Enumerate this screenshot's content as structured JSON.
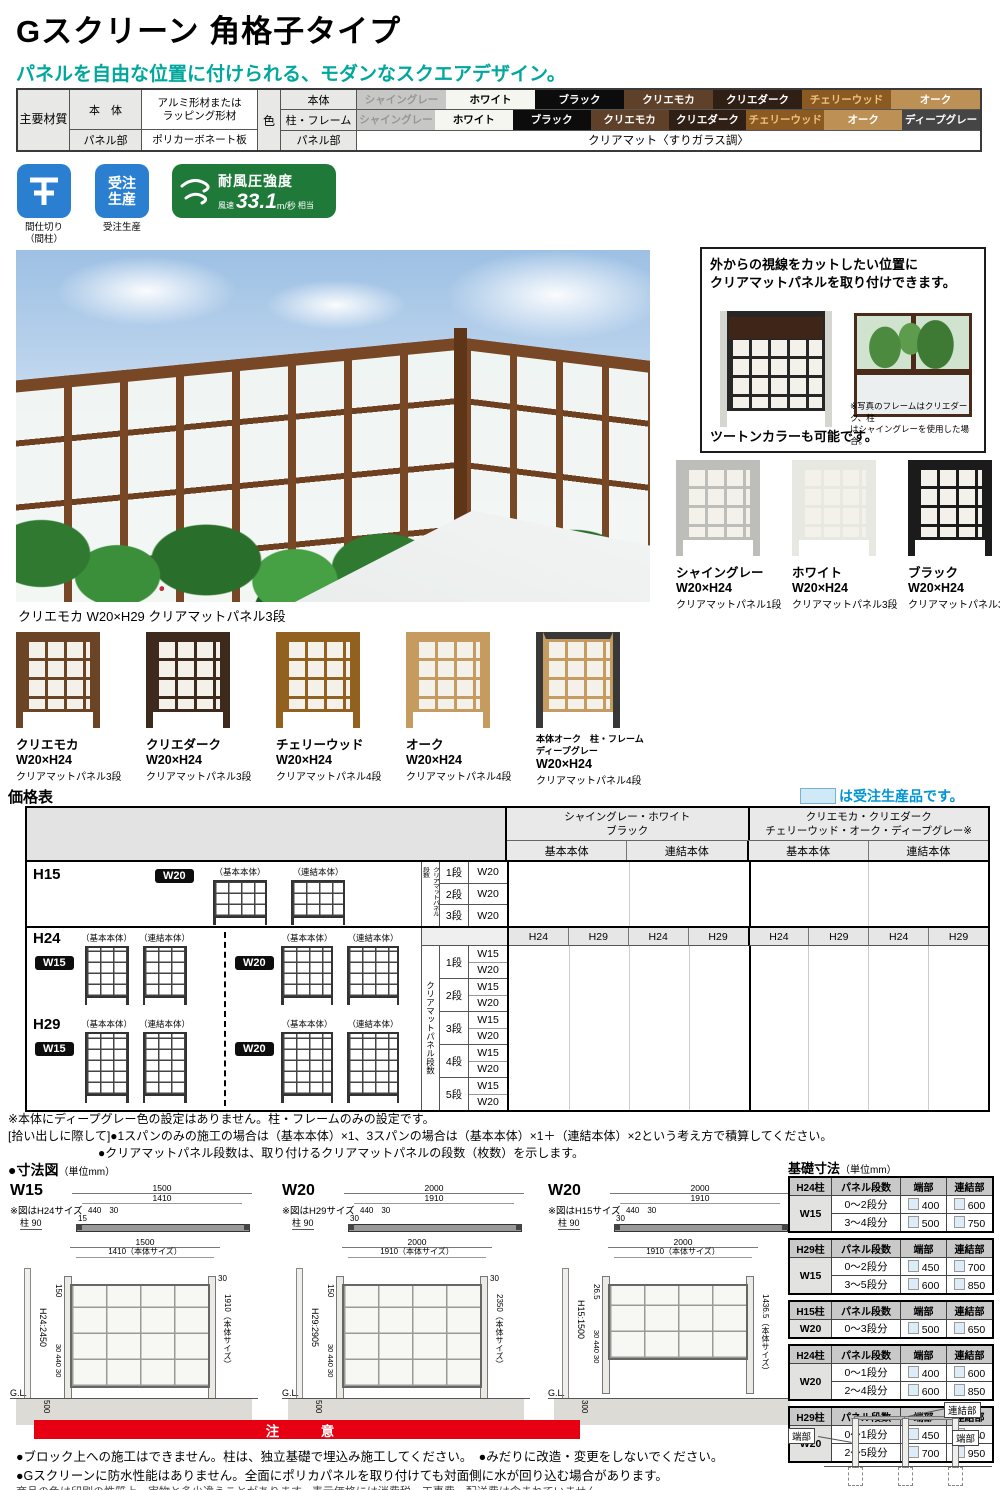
{
  "header": {
    "title": "Gスクリーン 角格子タイプ",
    "subtitle": "パネルを自由な位置に付けられる、モダンなスクエアデザイン。"
  },
  "colors": {
    "accent_teal": "#00a79c",
    "badge_blue": "#2b7fd0",
    "badge_green": "#1f7a3a",
    "notice_red": "#e60012",
    "order_note_blue": "#0096d6",
    "order_box_fill": "#cfe9f7"
  },
  "materials": {
    "main_label": "主要材質",
    "body_label": "本　体",
    "body_material_line1": "アルミ形材または",
    "body_material_line2": "ラッピング形材",
    "panel_label": "パネル部",
    "panel_material": "ポリカーボネート板",
    "color_label": "色",
    "color_rows": [
      {
        "label": "本体",
        "swatches": [
          {
            "name": "シャイングレー",
            "bg": "#c7c7c5",
            "fg": "#969694"
          },
          {
            "name": "ホワイト",
            "bg": "#f6f6f1",
            "fg": "#000000"
          },
          {
            "name": "ブラック",
            "bg": "#0c0c0c",
            "fg": "#ffffff"
          },
          {
            "name": "クリエモカ",
            "bg": "#5f4028",
            "fg": "#ffffff"
          },
          {
            "name": "クリエダーク",
            "bg": "#301f15",
            "fg": "#ffffff"
          },
          {
            "name": "チェリーウッド",
            "bg": "#8a5a22",
            "fg": "#f0c27d"
          },
          {
            "name": "オーク",
            "bg": "#bd9055",
            "fg": "#ffffff"
          }
        ]
      },
      {
        "label": "柱・フレーム",
        "swatches": [
          {
            "name": "シャイングレー",
            "bg": "#c7c7c5",
            "fg": "#969694"
          },
          {
            "name": "ホワイト",
            "bg": "#f6f6f1",
            "fg": "#000000"
          },
          {
            "name": "ブラック",
            "bg": "#0c0c0c",
            "fg": "#ffffff"
          },
          {
            "name": "クリエモカ",
            "bg": "#5f4028",
            "fg": "#ffffff"
          },
          {
            "name": "クリエダーク",
            "bg": "#301f15",
            "fg": "#ffffff"
          },
          {
            "name": "チェリーウッド",
            "bg": "#8a5a22",
            "fg": "#f0c27d"
          },
          {
            "name": "オーク",
            "bg": "#bd9055",
            "fg": "#ffffff"
          },
          {
            "name": "ディープグレー",
            "bg": "#454545",
            "fg": "#ffffff"
          }
        ]
      },
      {
        "label": "パネル部",
        "value": "クリアマット〈すりガラス調〉"
      }
    ]
  },
  "badges": {
    "partition_label1": "間仕切り",
    "partition_label2": "（間柱）",
    "order_icon_line1": "受注",
    "order_icon_line2": "生産",
    "order_label": "受注生産",
    "wind_title": "耐風圧強度",
    "wind_prefix": "風速",
    "wind_value": "33.1",
    "wind_unit": "m/秒",
    "wind_suffix": "相当"
  },
  "info_panel": {
    "title_line1": "外からの視線をカットしたい位置に",
    "title_line2": "クリアマットパネルを取り付けできます。",
    "caption_left": "ツートンカラーも可能です。",
    "caption_right_line1": "※写真のフレームはクリエダーク、柱",
    "caption_right_line2": "はシャイングレーを使用した場合。"
  },
  "variations": {
    "hero_caption": "クリエモカ W20×H29 クリアマットパネル3段",
    "right": [
      {
        "name": "シャイングレー",
        "size": "W20×H24",
        "panel": "クリアマットパネル1段",
        "frame": "#bdbdb9",
        "post": "#bdbdb9"
      },
      {
        "name": "ホワイト",
        "size": "W20×H24",
        "panel": "クリアマットパネル3段",
        "frame": "#e8e8e2",
        "post": "#e8e8e2"
      },
      {
        "name": "ブラック",
        "size": "W20×H24",
        "panel": "クリアマットパネル3段",
        "frame": "#1b1b1b",
        "post": "#1b1b1b"
      }
    ],
    "bottom": [
      {
        "name": "クリエモカ",
        "size": "W20×H24",
        "panel": "クリアマットパネル3段",
        "frame": "#6b4426",
        "post": "#6b4426"
      },
      {
        "name": "クリエダーク",
        "size": "W20×H24",
        "panel": "クリアマットパネル3段",
        "frame": "#3e2a1c",
        "post": "#3e2a1c"
      },
      {
        "name": "チェリーウッド",
        "size": "W20×H24",
        "panel": "クリアマットパネル4段",
        "frame": "#92601f",
        "post": "#92601f"
      },
      {
        "name": "オーク",
        "size": "W20×H24",
        "panel": "クリアマットパネル4段",
        "frame": "#c59b5f",
        "post": "#c59b5f"
      },
      {
        "name": "本体オーク　柱・フレームディープグレー",
        "size": "W20×H24",
        "panel": "クリアマットパネル4段",
        "frame": "#c59b5f",
        "post": "#383838",
        "topbar": "#383838",
        "small": true
      }
    ]
  },
  "price": {
    "heading": "価格表",
    "order_note": "は受注生産品です。",
    "groups": [
      {
        "line1": "シャイングレー・ホワイト",
        "line2": "ブラック"
      },
      {
        "line1": "クリエモカ・クリエダーク",
        "line2": "チェリーウッド・オーク・ディープグレー※"
      }
    ],
    "sub_cols": [
      "基本本体",
      "連結本体",
      "基本本体",
      "連結本体"
    ],
    "basic_label": "（基本本体）",
    "joint_label": "（連結本体）",
    "vertical_label": "クリアマットパネル段数",
    "h15_label": "H15",
    "h24_label": "H24",
    "h29_label": "H29",
    "w15_badge": "W15",
    "w20_badge": "W20",
    "h15_stages": [
      [
        "1段",
        "W20"
      ],
      [
        "2段",
        "W20"
      ],
      [
        "3段",
        "W20"
      ]
    ],
    "h_subheader": [
      "H24",
      "H29",
      "H24",
      "H29",
      "H24",
      "H29",
      "H24",
      "H29"
    ],
    "stages": [
      [
        "1段",
        "W15",
        "W20"
      ],
      [
        "2段",
        "W15",
        "W20"
      ],
      [
        "3段",
        "W15",
        "W20"
      ],
      [
        "4段",
        "W15",
        "W20"
      ],
      [
        "5段",
        "W15",
        "W20"
      ]
    ],
    "notes": [
      "※本体にディープグレー色の設定はありません。柱・フレームのみの設定です。",
      "[拾い出しに際して]●1スパンのみの施工の場合は（基本本体）×1、3スパンの場合は（基本本体）×1＋（連結本体）×2という考え方で積算してください。",
      "●クリアマットパネル段数は、取り付けるクリアマットパネルの段数（枚数）を示します。"
    ]
  },
  "dimensions": {
    "heading": "●寸法図",
    "unit": "（単位mm）",
    "diagrams": [
      {
        "name": "W15",
        "note": "※図はH24サイズ",
        "tw1": "1500",
        "tw2": "1410",
        "tsub": "440　30",
        "textra": "15",
        "tpost": "柱 90",
        "fw1": "1500",
        "fw2": "1410（本体サイズ）",
        "foff": "150",
        "fh": "H24:2450",
        "fbot": "30 440 30",
        "ftr": "30",
        "fbody": "1910（本体サイズ）",
        "fgl": "G.L.",
        "fdepth": "500"
      },
      {
        "name": "W20",
        "note": "※図はH29サイズ",
        "tw1": "2000",
        "tw2": "1910",
        "tsub": "440　30",
        "textra": "30",
        "tpost": "柱 90",
        "fw1": "2000",
        "fw2": "1910（本体サイズ）",
        "foff": "150",
        "fh": "H29:2905",
        "fbot": "30 440 30",
        "ftr": "30",
        "fbody": "2350（本体サイズ）",
        "fgl": "G.L.",
        "fdepth": "500"
      },
      {
        "name": "W20",
        "note": "※図はH15サイズ",
        "tw1": "2000",
        "tw2": "1910",
        "tsub": "440　30",
        "textra": "30",
        "tpost": "柱 90",
        "fw1": "2000",
        "fw2": "1910（本体サイズ）",
        "foff": "26.5",
        "fh": "H15:1500",
        "fbot": "30 440 30",
        "ftr": "",
        "fbody": "1436.5（本体サイズ）",
        "fgl": "G.L.",
        "fdepth": "300"
      }
    ]
  },
  "foundation": {
    "heading": "基礎寸法",
    "unit": "（単位mm）",
    "col2": "パネル段数",
    "col3": "端部",
    "col4": "連結部",
    "tables": [
      {
        "post": "H24柱",
        "width": "W15",
        "rows": [
          [
            "0～2段分",
            "400",
            "600"
          ],
          [
            "3～4段分",
            "500",
            "750"
          ]
        ]
      },
      {
        "post": "H29柱",
        "width": "W15",
        "rows": [
          [
            "0～2段分",
            "450",
            "700"
          ],
          [
            "3～5段分",
            "600",
            "850"
          ]
        ]
      },
      {
        "post": "H15柱",
        "width": "W20",
        "rows": [
          [
            "0～3段分",
            "500",
            "650"
          ]
        ]
      },
      {
        "post": "H24柱",
        "width": "W20",
        "rows": [
          [
            "0～1段分",
            "400",
            "600"
          ],
          [
            "2～4段分",
            "600",
            "850"
          ]
        ]
      },
      {
        "post": "H29柱",
        "width": "W20",
        "rows": [
          [
            "0～1段分",
            "450",
            "700"
          ],
          [
            "2～5段分",
            "700",
            "950"
          ]
        ]
      }
    ],
    "diagram_labels": [
      "端部",
      "連結部",
      "端部"
    ]
  },
  "notice": {
    "banner": "注　意",
    "line1": "●ブロック上への施工はできません。柱は、独立基礎で埋込み施工してください。　●みだりに改造・変更をしないでください。",
    "line2": "●Gスクリーンに防水性能はありません。全面にポリカパネルを取り付けても対面側に水が回り込む場合があります。",
    "footer": "商品の色は印刷の性質上、実物と多少違うことがあります。表示価格には消費税・工事費・配送費は含まれていません。"
  }
}
